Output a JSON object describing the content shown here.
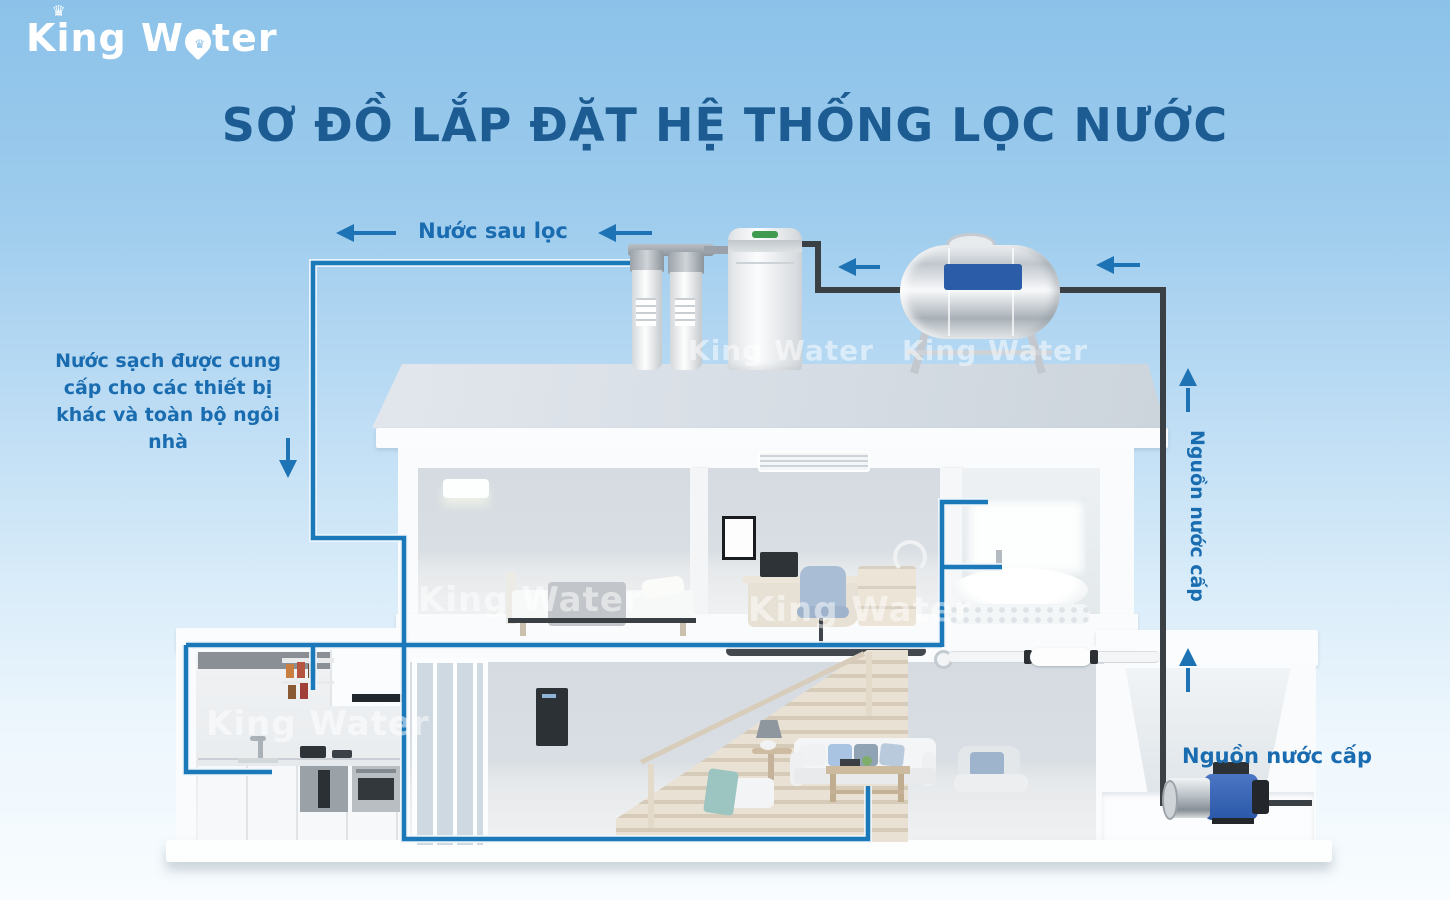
{
  "logo": {
    "text_before_drop": "King W",
    "text_after_drop": "ter",
    "crown_glyph": "♛",
    "watermark_text": "King Water"
  },
  "title": "SƠ ĐỒ LẮP ĐẶT HỆ THỐNG LỌC NƯỚC",
  "labels": {
    "filtered_water": "Nước sau lọc",
    "clean_water_note": "Nước sạch được cung cấp cho các thiết bị khác và toàn bộ ngôi nhà",
    "water_supply_vertical": "Nguồn nước cấp",
    "water_supply_pump": "Nguồn nước cấp"
  },
  "equipment": {
    "filters": "twin-cartridge-prefilter",
    "softener": "water-softener-cabinet",
    "tank": "horizontal-stainless-storage-tank",
    "pump": "booster-pump"
  },
  "colors": {
    "background_top": "#8cc2e9",
    "background_bottom": "#f8fcfe",
    "title_text": "#1c5c92",
    "label_text": "#1a6cb0",
    "clean_water_pipe": "#1b79ba",
    "supply_water_pipe": "#3b4045",
    "flow_arrow": "#1d73b4",
    "tank_label_panel": "#2b5ca8",
    "roof": "#d6dde4"
  }
}
